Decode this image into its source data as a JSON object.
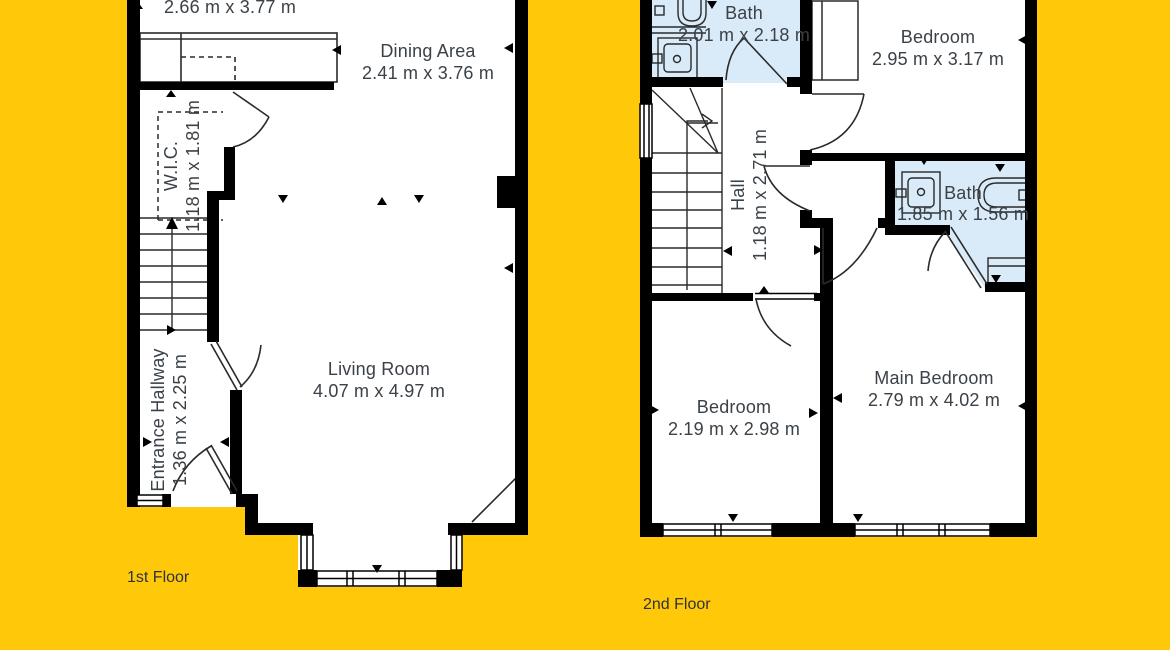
{
  "palette": {
    "background": "#ffc90a",
    "wall": "#000000",
    "bath_fill": "#d9eaf8",
    "line": "#2a2a2a",
    "text": "#3a4147"
  },
  "floor1": {
    "label": "1st Floor",
    "rooms": [
      {
        "name": "",
        "dims": "2.66 m x 3.77 m"
      },
      {
        "name": "Dining Area",
        "dims": "2.41 m x 3.76 m"
      },
      {
        "name": "W.I.C.",
        "dims": "1.18 m x 1.81 m"
      },
      {
        "name": "Entrance Hallway",
        "dims": "1.36 m x 2.25 m"
      },
      {
        "name": "Living Room",
        "dims": "4.07 m x 4.97 m"
      }
    ]
  },
  "floor2": {
    "label": "2nd Floor",
    "rooms": [
      {
        "name": "Bath",
        "dims": "2.01 m x 2.18 m"
      },
      {
        "name": "Bedroom",
        "dims": "2.95 m x 3.17 m"
      },
      {
        "name": "Hall",
        "dims": "1.18 m x 2.71 m"
      },
      {
        "name": "Bath",
        "dims": "1.85 m x 1.56 m"
      },
      {
        "name": "Bedroom",
        "dims": "2.19 m x 2.98 m"
      },
      {
        "name": "Main Bedroom",
        "dims": "2.79 m x 4.02 m"
      }
    ]
  }
}
